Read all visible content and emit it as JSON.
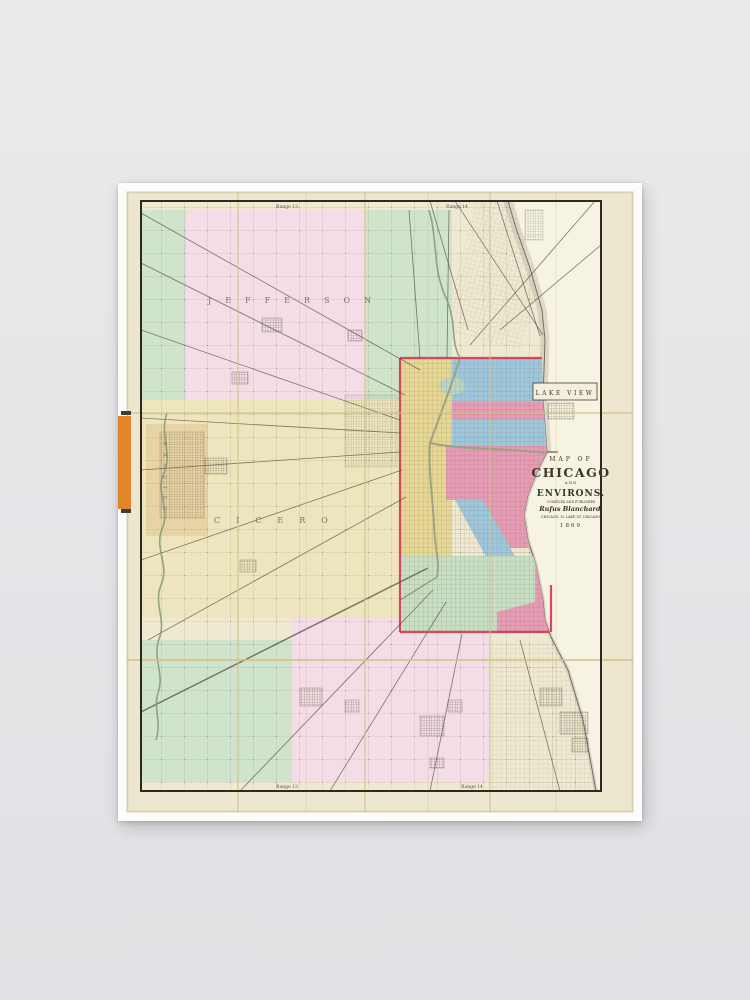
{
  "scene": {
    "background": "#e4e6e8",
    "description": "framed poster product photo on gray wall"
  },
  "poster": {
    "mat_color": "#fcfcfb",
    "paper_color": "#ede7d0"
  },
  "map": {
    "title_block": {
      "line1": "MAP OF",
      "line2": "CHICAGO",
      "line3": "AND",
      "line4": "ENVIRONS.",
      "line5": "COMPILED AND PUBLISHED",
      "line6": "Rufus Blanchard,",
      "line7": "CHICAGO, 52 LAKE ST. CHICAGO.",
      "line8": "1869"
    },
    "labels": {
      "township_nw": "JEFFERSON",
      "township_w": "CICERO",
      "township_left": "PROVISO",
      "lakeview": "LAKE VIEW",
      "range_top_w": "Range 13",
      "range_top_e": "Range 14",
      "range_bottom_w": "Range 13",
      "range_bottom_e": "Range 14"
    },
    "colors": {
      "region_green": "#cfe3cd",
      "region_pink": "#f4dde7",
      "region_yellow": "#ece5bd",
      "city_blue": "#9fc7dc",
      "city_pink": "#e59cb4",
      "city_yellow": "#e7d795",
      "city_green": "#c8dfc4",
      "lake": "#f7f3e3",
      "boundary_red": "#d63a52",
      "tab_orange": "#e1862b",
      "paper": "#ede7d0"
    }
  }
}
